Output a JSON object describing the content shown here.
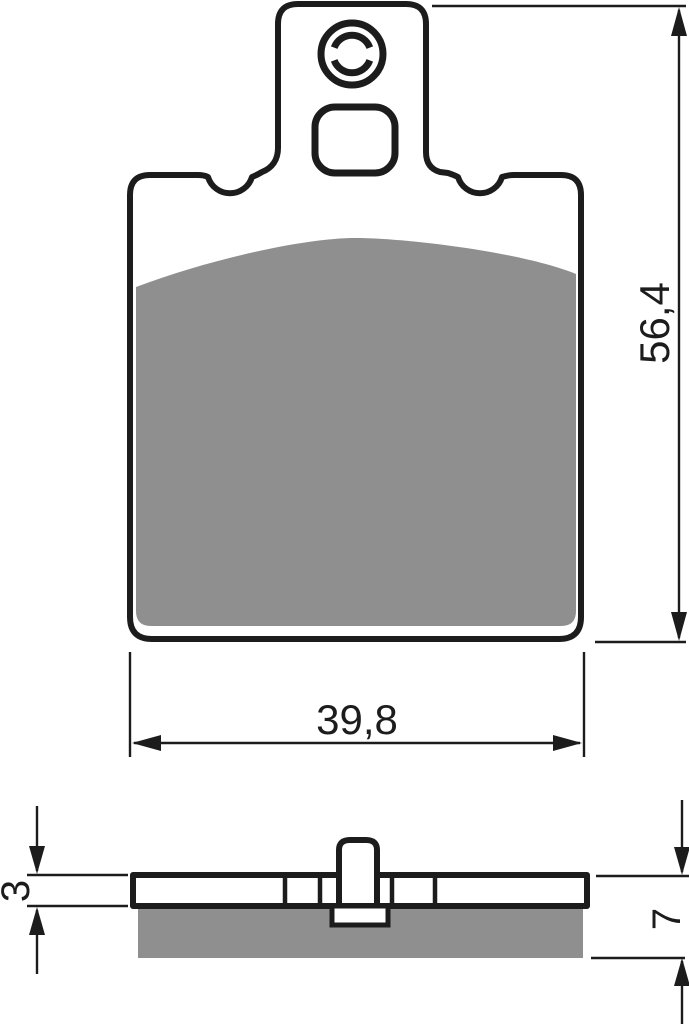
{
  "dimensions": {
    "overall_height_mm": "56,4",
    "pad_width_mm": "39,8",
    "backplate_thickness_mm": "3",
    "total_thickness_mm": "7"
  },
  "colors": {
    "line": "#1c1c1c",
    "friction_material": "#8f8f90",
    "background": "#ffffff"
  }
}
